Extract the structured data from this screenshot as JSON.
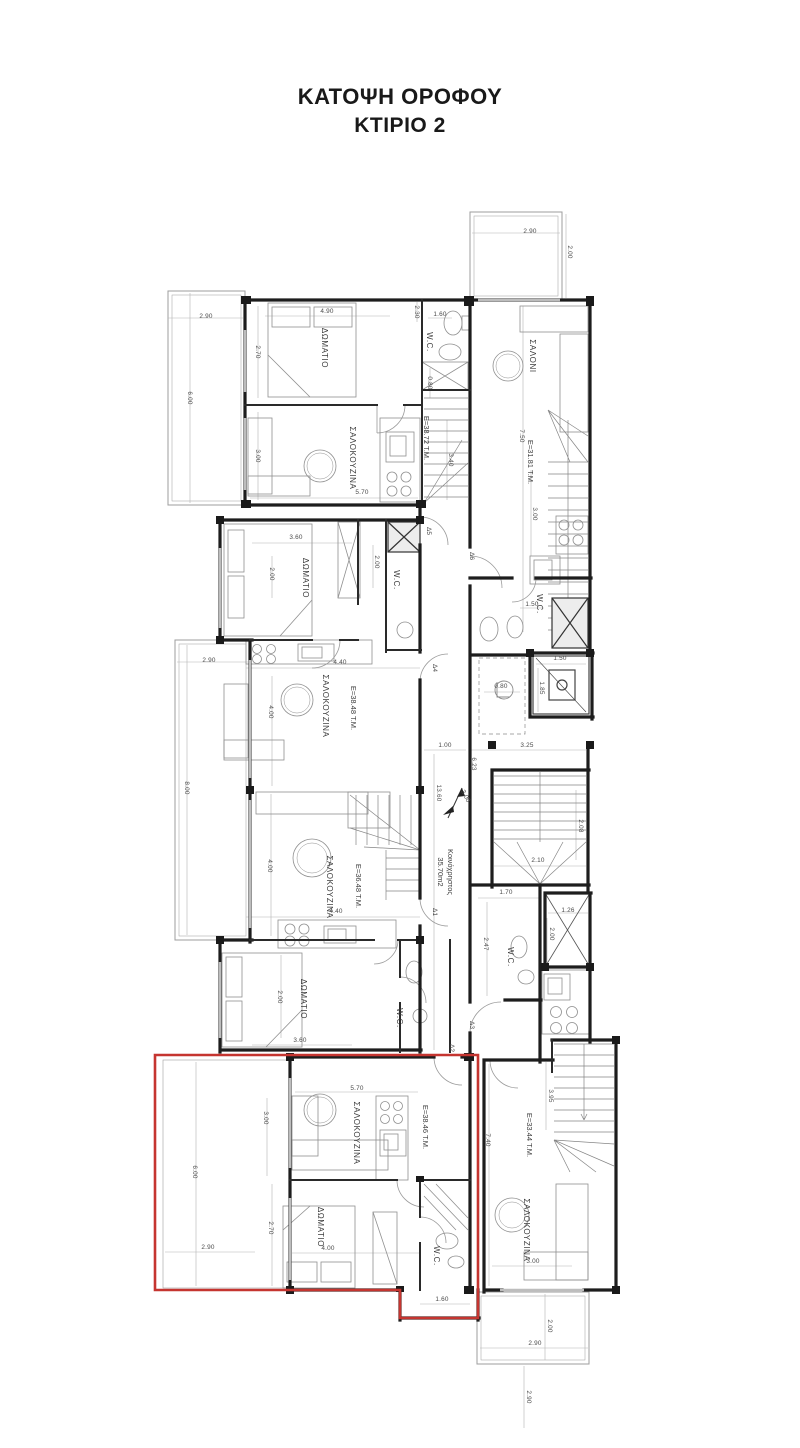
{
  "title": {
    "line1": "ΚΑΤΟΨΗ ΟΡΟΦΟΥ",
    "line2": "ΚΤΙΡΙΟ 2"
  },
  "colors": {
    "highlight_outline": "#c53530",
    "wall": "#1d1d1d",
    "furniture": "#8f8f8f",
    "dimension": "#4a4a4a"
  },
  "plan": {
    "common_area_name": "Κοινόχρηστος",
    "common_area_value": "35.70m2",
    "apartment_areas": [
      "Ε=38.72 Τ.Μ.",
      "Ε=31.81 Τ.Μ.",
      "Ε=38.48 Τ.Μ.",
      "Ε=36.48 Τ.Μ.",
      "Ε=38.46 Τ.Μ.",
      "Ε=33.44 Τ.Μ."
    ],
    "room_names": [
      "ΔΩΜΑΤΙΟ",
      "ΣΑΛΟΚΟΥΖΙΝΑ",
      "ΣΑΛΟΝΙ",
      "W.C."
    ],
    "door_tags": [
      "Δ1",
      "Δ2",
      "Δ3",
      "Δ4",
      "Δ5",
      "Δ6"
    ]
  },
  "text_labels": [
    {
      "n": "apt1-bedroom-label",
      "t": "ΔΩΜΑΤΙΟ",
      "x": 322,
      "y": 348,
      "r": 90,
      "c": "room"
    },
    {
      "n": "apt1-living-label",
      "t": "ΣΑΛΟΚΟΥΖΙΝΑ",
      "x": 350,
      "y": 458,
      "r": 90,
      "c": "room"
    },
    {
      "n": "apt1-wc-label",
      "t": "W.C.",
      "x": 427,
      "y": 342,
      "r": 90,
      "c": "room"
    },
    {
      "n": "apt1-area-label",
      "t": "Ε=38.72 Τ.Μ.",
      "x": 424,
      "y": 438,
      "r": 90,
      "c": "area"
    },
    {
      "n": "apt2-living-label",
      "t": "ΣΑΛΟΝΙ",
      "x": 530,
      "y": 356,
      "r": 90,
      "c": "room"
    },
    {
      "n": "apt2-area-label",
      "t": "Ε=31.81 Τ.Μ.",
      "x": 528,
      "y": 462,
      "r": 90,
      "c": "area"
    },
    {
      "n": "apt2-wc-label",
      "t": "W.C.",
      "x": 537,
      "y": 604,
      "r": 90,
      "c": "room"
    },
    {
      "n": "apt3-bedroom-label",
      "t": "ΔΩΜΑΤΙΟ",
      "x": 303,
      "y": 578,
      "r": 90,
      "c": "room"
    },
    {
      "n": "apt3-wc-label",
      "t": "W.C.",
      "x": 394,
      "y": 580,
      "r": 90,
      "c": "room"
    },
    {
      "n": "apt3-living-label",
      "t": "ΣΑΛΟΚΟΥΖΙΝΑ",
      "x": 323,
      "y": 706,
      "r": 90,
      "c": "room"
    },
    {
      "n": "apt3-area-label",
      "t": "Ε=38.48 Τ.Μ.",
      "x": 351,
      "y": 708,
      "r": 90,
      "c": "area"
    },
    {
      "n": "apt4-living-label",
      "t": "ΣΑΛΟΚΟΥΖΙΝΑ",
      "x": 327,
      "y": 887,
      "r": 90,
      "c": "room"
    },
    {
      "n": "apt4-area-label",
      "t": "Ε=36.48 Τ.Μ.",
      "x": 356,
      "y": 886,
      "r": 90,
      "c": "area"
    },
    {
      "n": "apt4-bedroom-label",
      "t": "ΔΩΜΑΤΙΟ",
      "x": 301,
      "y": 999,
      "r": 90,
      "c": "room"
    },
    {
      "n": "apt4-wc-label",
      "t": "W.C.",
      "x": 397,
      "y": 1018,
      "r": 90,
      "c": "room"
    },
    {
      "n": "common-area-name-label",
      "t": "Κοινόχρηστος",
      "x": 448,
      "y": 872,
      "r": 90,
      "c": "common"
    },
    {
      "n": "common-area-value-label",
      "t": "35.70m2",
      "x": 438,
      "y": 872,
      "r": 90,
      "c": "common"
    },
    {
      "n": "apt6-wc-label",
      "t": "W.C.",
      "x": 508,
      "y": 957,
      "r": 90,
      "c": "room"
    },
    {
      "n": "apt6-living-label",
      "t": "ΣΑΛΟΚΟΥΖΙΝΑ",
      "x": 524,
      "y": 1230,
      "r": 90,
      "c": "room"
    },
    {
      "n": "apt6-area-label",
      "t": "Ε=33.44 Τ.Μ.",
      "x": 527,
      "y": 1135,
      "r": 90,
      "c": "area"
    },
    {
      "n": "apt5-living-label",
      "t": "ΣΑΛΟΚΟΥΖΙΝΑ",
      "x": 354,
      "y": 1133,
      "r": 90,
      "c": "room"
    },
    {
      "n": "apt5-area-label",
      "t": "Ε=38.46 Τ.Μ.",
      "x": 423,
      "y": 1127,
      "r": 90,
      "c": "area"
    },
    {
      "n": "apt5-bedroom-label",
      "t": "ΔΩΜΑΤΙΟ",
      "x": 318,
      "y": 1227,
      "r": 90,
      "c": "room"
    },
    {
      "n": "apt5-wc-label",
      "t": "W.C.",
      "x": 434,
      "y": 1256,
      "r": 90,
      "c": "room"
    },
    {
      "n": "door-label",
      "t": "Δ1",
      "x": 433,
      "y": 912,
      "r": 90,
      "c": "door"
    },
    {
      "n": "door-label",
      "t": "Δ2",
      "x": 450,
      "y": 1048,
      "r": 90,
      "c": "door"
    },
    {
      "n": "door-label",
      "t": "Δ3",
      "x": 470,
      "y": 1025,
      "r": 90,
      "c": "door"
    },
    {
      "n": "door-label",
      "t": "Δ4",
      "x": 433,
      "y": 668,
      "r": 90,
      "c": "door"
    },
    {
      "n": "door-label",
      "t": "Δ5",
      "x": 427,
      "y": 531,
      "r": 90,
      "c": "door"
    },
    {
      "n": "door-label",
      "t": "Δ6",
      "x": 470,
      "y": 556,
      "r": 90,
      "c": "door"
    },
    {
      "n": "dim-label",
      "t": "2.90",
      "x": 206,
      "y": 318,
      "c": "dim"
    },
    {
      "n": "dim-label",
      "t": "6.00",
      "x": 188,
      "y": 398,
      "r": 90,
      "c": "dim"
    },
    {
      "n": "dim-label",
      "t": "4.90",
      "x": 327,
      "y": 313,
      "c": "dim"
    },
    {
      "n": "dim-label",
      "t": "2.70",
      "x": 256,
      "y": 352,
      "r": 90,
      "c": "dim"
    },
    {
      "n": "dim-label",
      "t": "3.00",
      "x": 256,
      "y": 456,
      "r": 90,
      "c": "dim"
    },
    {
      "n": "dim-label",
      "t": "5.70",
      "x": 362,
      "y": 494,
      "c": "dim"
    },
    {
      "n": "dim-label",
      "t": "2.30",
      "x": 415,
      "y": 312,
      "r": 90,
      "c": "dim"
    },
    {
      "n": "dim-label",
      "t": "1.60",
      "x": 440,
      "y": 316,
      "c": "dim"
    },
    {
      "n": "dim-label",
      "t": "0.80",
      "x": 428,
      "y": 383,
      "r": 90,
      "c": "dim"
    },
    {
      "n": "dim-label",
      "t": "3.40",
      "x": 449,
      "y": 460,
      "r": 90,
      "c": "dim"
    },
    {
      "n": "dim-label",
      "t": "2.90",
      "x": 530,
      "y": 233,
      "c": "dim"
    },
    {
      "n": "dim-label",
      "t": "2.00",
      "x": 568,
      "y": 252,
      "r": 90,
      "c": "dim"
    },
    {
      "n": "dim-label",
      "t": "7.50",
      "x": 520,
      "y": 436,
      "r": 90,
      "c": "dim"
    },
    {
      "n": "dim-label",
      "t": "3.00",
      "x": 533,
      "y": 514,
      "r": 90,
      "c": "dim"
    },
    {
      "n": "dim-label",
      "t": "1.50",
      "x": 532,
      "y": 606,
      "c": "dim"
    },
    {
      "n": "dim-label",
      "t": "3.60",
      "x": 296,
      "y": 539,
      "c": "dim"
    },
    {
      "n": "dim-label",
      "t": "2.00",
      "x": 270,
      "y": 574,
      "r": 90,
      "c": "dim"
    },
    {
      "n": "dim-label",
      "t": "2.00",
      "x": 375,
      "y": 562,
      "r": 90,
      "c": "dim"
    },
    {
      "n": "dim-label",
      "t": "2.90",
      "x": 209,
      "y": 662,
      "c": "dim"
    },
    {
      "n": "dim-label",
      "t": "8.00",
      "x": 185,
      "y": 788,
      "r": 90,
      "c": "dim"
    },
    {
      "n": "dim-label",
      "t": "4.40",
      "x": 340,
      "y": 664,
      "c": "dim"
    },
    {
      "n": "dim-label",
      "t": "4.00",
      "x": 269,
      "y": 712,
      "r": 90,
      "c": "dim"
    },
    {
      "n": "dim-label",
      "t": "1.50",
      "x": 560,
      "y": 660,
      "c": "dim"
    },
    {
      "n": "dim-label",
      "t": "1.85",
      "x": 540,
      "y": 688,
      "r": 90,
      "c": "dim"
    },
    {
      "n": "dim-label",
      "t": "0.80",
      "x": 501,
      "y": 688,
      "c": "dim"
    },
    {
      "n": "dim-label",
      "t": "1.00",
      "x": 445,
      "y": 747,
      "c": "dim"
    },
    {
      "n": "dim-label",
      "t": "3.25",
      "x": 527,
      "y": 747,
      "c": "dim"
    },
    {
      "n": "dim-label",
      "t": "6.23",
      "x": 472,
      "y": 764,
      "r": 90,
      "c": "dim"
    },
    {
      "n": "dim-label",
      "t": "13.60",
      "x": 437,
      "y": 793,
      "r": 90,
      "c": "dim"
    },
    {
      "n": "dim-label",
      "t": "3.00",
      "x": 464,
      "y": 797,
      "r": 62,
      "c": "dim"
    },
    {
      "n": "dim-label",
      "t": "2.10",
      "x": 538,
      "y": 862,
      "c": "dim"
    },
    {
      "n": "dim-label",
      "t": "2.08",
      "x": 579,
      "y": 826,
      "r": 90,
      "c": "dim"
    },
    {
      "n": "dim-label",
      "t": "4.00",
      "x": 268,
      "y": 866,
      "r": 90,
      "c": "dim"
    },
    {
      "n": "dim-label",
      "t": "4.40",
      "x": 336,
      "y": 913,
      "c": "dim"
    },
    {
      "n": "dim-label",
      "t": "1.70",
      "x": 506,
      "y": 894,
      "c": "dim"
    },
    {
      "n": "dim-label",
      "t": "2.47",
      "x": 484,
      "y": 944,
      "r": 90,
      "c": "dim"
    },
    {
      "n": "dim-label",
      "t": "1.26",
      "x": 568,
      "y": 912,
      "c": "dim"
    },
    {
      "n": "dim-label",
      "t": "2.00",
      "x": 550,
      "y": 934,
      "r": 90,
      "c": "dim"
    },
    {
      "n": "dim-label",
      "t": "3.60",
      "x": 300,
      "y": 1042,
      "c": "dim"
    },
    {
      "n": "dim-label",
      "t": "2.00",
      "x": 278,
      "y": 997,
      "r": 90,
      "c": "dim"
    },
    {
      "n": "dim-label",
      "t": "5.70",
      "x": 357,
      "y": 1090,
      "c": "dim"
    },
    {
      "n": "dim-label",
      "t": "3.00",
      "x": 264,
      "y": 1118,
      "r": 90,
      "c": "dim"
    },
    {
      "n": "dim-label",
      "t": "6.00",
      "x": 193,
      "y": 1172,
      "r": 90,
      "c": "dim"
    },
    {
      "n": "dim-label",
      "t": "2.90",
      "x": 208,
      "y": 1249,
      "c": "dim"
    },
    {
      "n": "dim-label",
      "t": "2.70",
      "x": 269,
      "y": 1228,
      "r": 90,
      "c": "dim"
    },
    {
      "n": "dim-label",
      "t": "4.00",
      "x": 328,
      "y": 1250,
      "c": "dim"
    },
    {
      "n": "dim-label",
      "t": "1.60",
      "x": 442,
      "y": 1301,
      "c": "dim"
    },
    {
      "n": "dim-label",
      "t": "7.40",
      "x": 486,
      "y": 1140,
      "r": 90,
      "c": "dim"
    },
    {
      "n": "dim-label",
      "t": "3.95",
      "x": 549,
      "y": 1096,
      "r": 90,
      "c": "dim"
    },
    {
      "n": "dim-label",
      "t": "3.00",
      "x": 533,
      "y": 1263,
      "c": "dim"
    },
    {
      "n": "dim-label",
      "t": "2.90",
      "x": 535,
      "y": 1345,
      "c": "dim"
    },
    {
      "n": "dim-label",
      "t": "2.00",
      "x": 548,
      "y": 1326,
      "r": 90,
      "c": "dim"
    },
    {
      "n": "dim-label",
      "t": "2.90",
      "x": 527,
      "y": 1397,
      "r": 90,
      "c": "dim"
    }
  ]
}
